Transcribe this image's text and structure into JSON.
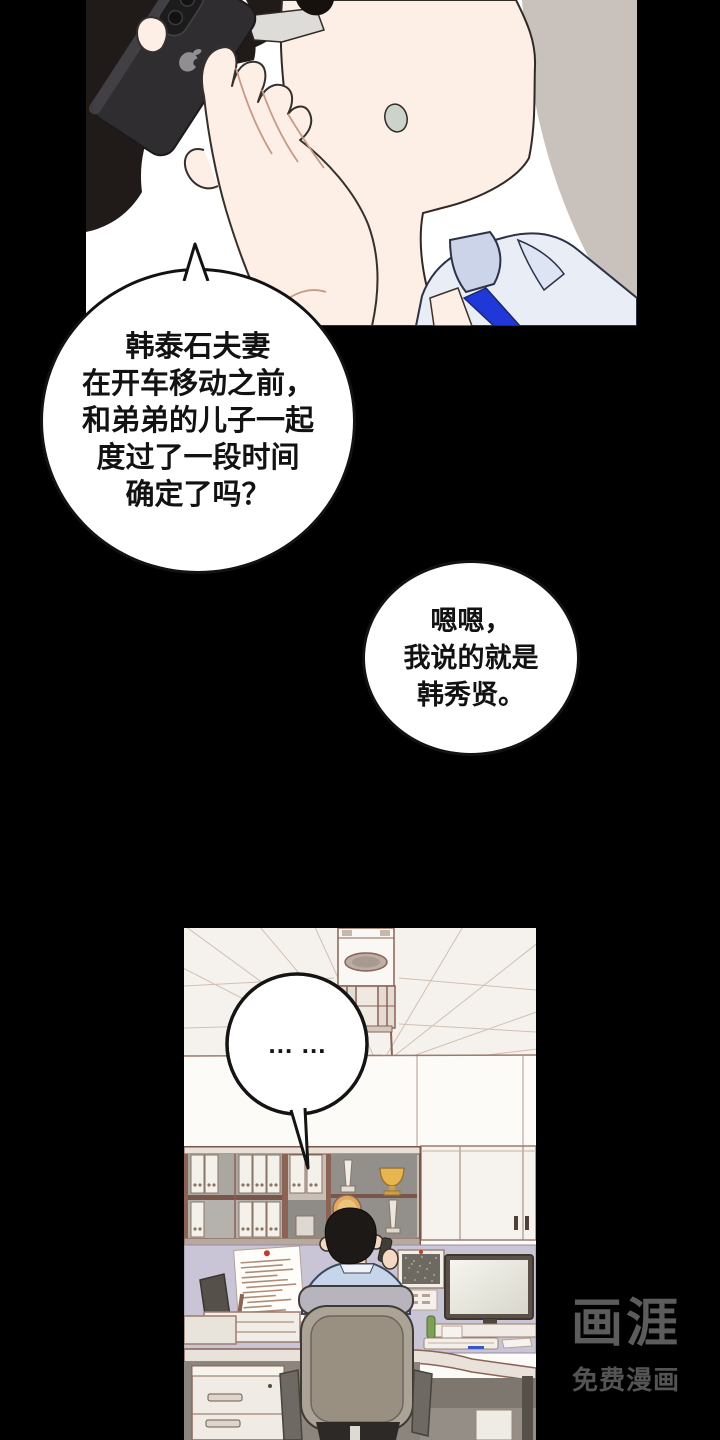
{
  "page": {
    "background": "#000000",
    "type": "comic-page"
  },
  "speech": {
    "bubble1": {
      "lines": [
        "韩泰石夫妻",
        "在开车移动之前，",
        "和弟弟的儿子一起",
        "度过了一段时间",
        "确定了吗？"
      ]
    },
    "bubble2": {
      "lines": [
        "嗯嗯，",
        "我说的就是",
        "韩秀贤。"
      ]
    },
    "office_bubble": {
      "text": "… …"
    }
  },
  "watermark": {
    "logo": "画涯",
    "tagline": "免费漫画"
  },
  "colors": {
    "page_bg": "#000000",
    "panel1_bg": "#c9c2bc",
    "glow": "#ffffff",
    "skin": "#fdeee6",
    "hair": "#201b18",
    "phone_body": "#2f2d2f",
    "shirt": "#e9edf6",
    "tie_blue": "#2038d8",
    "ceiling": "#f5f2ee",
    "wall": "#fcfbf8",
    "partition": "#c9c5d6",
    "chair_back": "#9a9082",
    "trophy_gold": "#e7b651",
    "watermark_gray": "#5c5c5c"
  }
}
